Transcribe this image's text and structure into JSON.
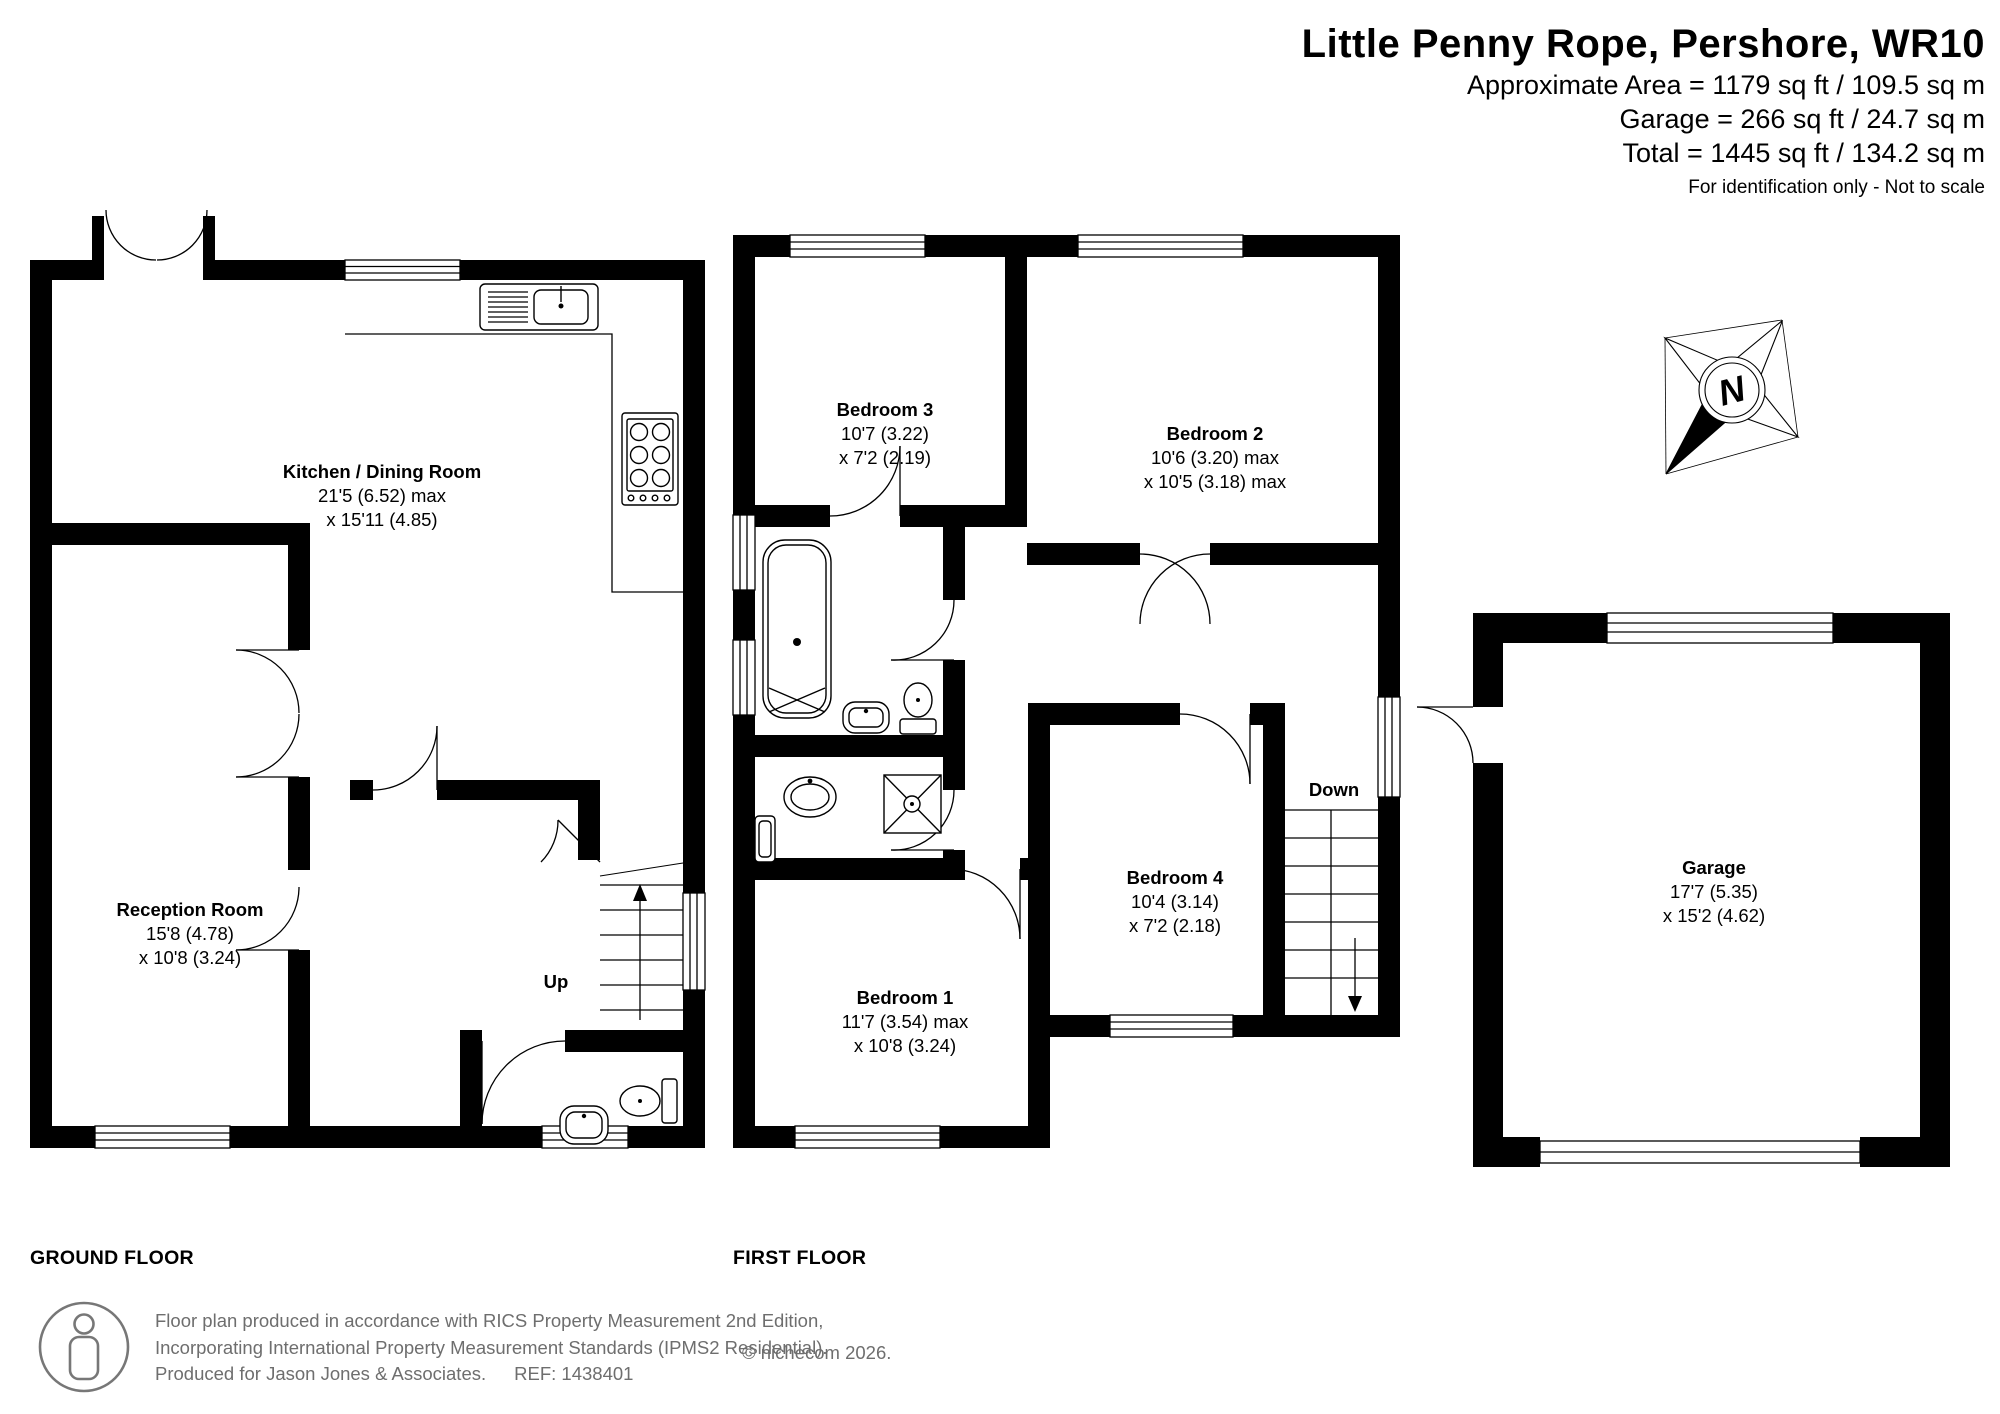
{
  "header": {
    "title": "Little Penny Rope, Pershore, WR10",
    "approx_area": "Approximate Area = 1179 sq ft / 109.5 sq m",
    "garage_area": "Garage = 266 sq ft / 24.7 sq m",
    "total_area": "Total = 1445 sq ft / 134.2 sq m",
    "disclaimer": "For identification only - Not to scale"
  },
  "floors": {
    "ground": "GROUND FLOOR",
    "first": "FIRST FLOOR"
  },
  "rooms": {
    "kitchen": {
      "name": "Kitchen / Dining Room",
      "dims1": "21'5 (6.52) max",
      "dims2": "x 15'11 (4.85)"
    },
    "reception": {
      "name": "Reception Room",
      "dims1": "15'8 (4.78)",
      "dims2": "x 10'8 (3.24)"
    },
    "bedroom1": {
      "name": "Bedroom 1",
      "dims1": "11'7 (3.54) max",
      "dims2": "x 10'8 (3.24)"
    },
    "bedroom2": {
      "name": "Bedroom 2",
      "dims1": "10'6 (3.20) max",
      "dims2": "x 10'5 (3.18) max"
    },
    "bedroom3": {
      "name": "Bedroom 3",
      "dims1": "10'7 (3.22)",
      "dims2": "x 7'2 (2.19)"
    },
    "bedroom4": {
      "name": "Bedroom 4",
      "dims1": "10'4 (3.14)",
      "dims2": "x 7'2 (2.18)"
    },
    "garage": {
      "name": "Garage",
      "dims1": "17'7 (5.35)",
      "dims2": "x 15'2 (4.62)"
    }
  },
  "stairs": {
    "up": "Up",
    "down": "Down"
  },
  "compass": {
    "north": "N"
  },
  "footer": {
    "line1": "Floor plan produced in accordance with RICS Property Measurement 2nd Edition,",
    "line2": "Incorporating International Property Measurement Standards (IPMS2 Residential).",
    "line3": "Produced for Jason Jones & Associates.",
    "ref": "REF: 1438401",
    "copyright": "© nichecom 2026."
  },
  "colors": {
    "wall": "#000000",
    "text": "#000000",
    "muted": "#6e6e6e"
  }
}
